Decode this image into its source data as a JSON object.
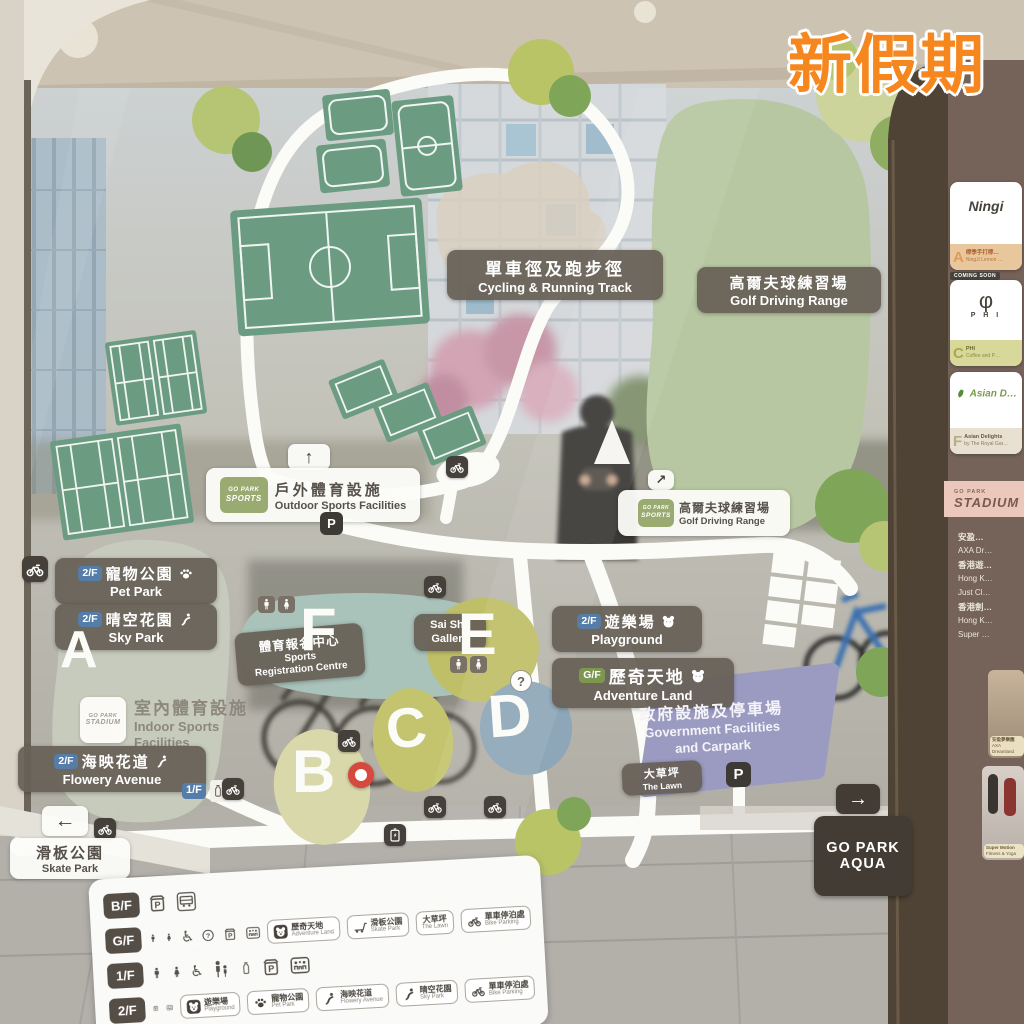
{
  "watermark": "新假期",
  "map": {
    "zones": [
      "A",
      "B",
      "C",
      "D",
      "E",
      "F"
    ],
    "sports_badge": {
      "line1": "GO PARK",
      "line2": "SPORTS"
    },
    "stadium_badge": {
      "line1": "GO PARK",
      "line2": "STADIUM"
    },
    "labels": {
      "cycling": {
        "zh": "單車徑及跑步徑",
        "en": "Cycling & Running Track"
      },
      "golf_zone": {
        "zh": "高爾夫球練習場",
        "en": "Golf Driving Range"
      },
      "outdoor": {
        "zh": "戶外體育設施",
        "en": "Outdoor Sports Facilities",
        "arrow": "↑"
      },
      "golf_sign": {
        "zh": "高爾夫球練習場",
        "en": "Golf Driving Range",
        "arrow": "↗"
      },
      "pet_park": {
        "floor": "2/F",
        "zh": "寵物公園",
        "en": "Pet Park"
      },
      "sky_park": {
        "floor": "2/F",
        "zh": "晴空花園",
        "en": "Sky Park"
      },
      "indoor": {
        "zh": "室內體育設施",
        "en1": "Indoor Sports",
        "en2": "Facilities"
      },
      "flowery": {
        "floor": "2/F",
        "zh": "海映花道",
        "en": "Flowery Avenue"
      },
      "floor_1f": "1/F",
      "sports_reg": {
        "zh": "體育報名中心",
        "en1": "Sports",
        "en2": "Registration Centre"
      },
      "gallery": {
        "en1": "Sai Sha",
        "en2": "Gallery"
      },
      "playground": {
        "floor": "2/F",
        "zh": "遊樂場",
        "en": "Playground"
      },
      "adventure": {
        "floor": "G/F",
        "zh": "歷奇天地",
        "en": "Adventure Land"
      },
      "government": {
        "zh": "政府設施及停車場",
        "en1": "Government Facilities",
        "en2": "and Carpark"
      },
      "lawn": {
        "zh": "大草坪",
        "en": "The Lawn"
      },
      "skate": {
        "zh": "滑板公園",
        "en": "Skate Park",
        "arrow": "←"
      },
      "aqua": {
        "line1": "GO PARK",
        "line2": "AQUA",
        "arrow": "→"
      },
      "parking": "P"
    }
  },
  "legend": {
    "rows": [
      {
        "floor": "B/F",
        "icons": [
          "covered-parking",
          "shuttle-bus"
        ],
        "tags": []
      },
      {
        "floor": "G/F",
        "icons": [
          "male",
          "female",
          "wheelchair",
          "info",
          "covered-parking",
          "family-room"
        ],
        "tags": [
          {
            "zh": "歷奇天地",
            "en": "Adventure Land",
            "icon": "bear"
          },
          {
            "zh": "滑板公園",
            "en": "Skate Park",
            "icon": "scooter"
          },
          {
            "zh": "大草坪",
            "en": "The Lawn",
            "icon": ""
          },
          {
            "zh": "單車停泊處",
            "en": "Bike Parking",
            "icon": "bike"
          }
        ]
      },
      {
        "floor": "1/F",
        "icons": [
          "male",
          "female",
          "wheelchair",
          "nursing-room",
          "water-refill",
          "covered-parking",
          "family-room"
        ],
        "tags": []
      },
      {
        "floor": "2/F",
        "icons": [
          "covered-parking",
          "family-room"
        ],
        "tags": [
          {
            "zh": "遊樂場",
            "en": "Playground",
            "icon": "bear"
          },
          {
            "zh": "寵物公園",
            "en": "Pet Park",
            "icon": "paw"
          },
          {
            "zh": "海映花道",
            "en": "Flowery Avenue",
            "icon": "runner"
          },
          {
            "zh": "晴空花園",
            "en": "Sky Park",
            "icon": "runner"
          },
          {
            "zh": "單車停泊處",
            "en": "Bike Parking",
            "icon": "bike"
          }
        ]
      }
    ]
  },
  "directory": {
    "cards": [
      {
        "letter": "A",
        "logo": "Ningi",
        "zh": "檸季手打檸…",
        "en": "NingJi Lemon …",
        "note": "COMING SOON"
      },
      {
        "letter": "C",
        "logo": "φ",
        "logo_sub": "P H I",
        "zh": "PHI",
        "en": "Coffee and P…"
      },
      {
        "letter": "F",
        "logo": "Asian D…",
        "zh": "Asian Delights",
        "en": "by The Royal Gar…"
      }
    ],
    "stadium_band": {
      "small": "GO PARK",
      "big": "STADIUM"
    },
    "tenants": [
      "安盈…",
      "AXA Dr…",
      "香港遊…",
      "Hong K…",
      "Just Cl…",
      "香港劍…",
      "Hong K…",
      "Super …"
    ],
    "photos": [
      {
        "zh": "安盈夢樂園",
        "en": "AXA Dreamland"
      },
      {
        "en1": "Super Motion",
        "en2": "Fitness & Yoga"
      }
    ]
  }
}
